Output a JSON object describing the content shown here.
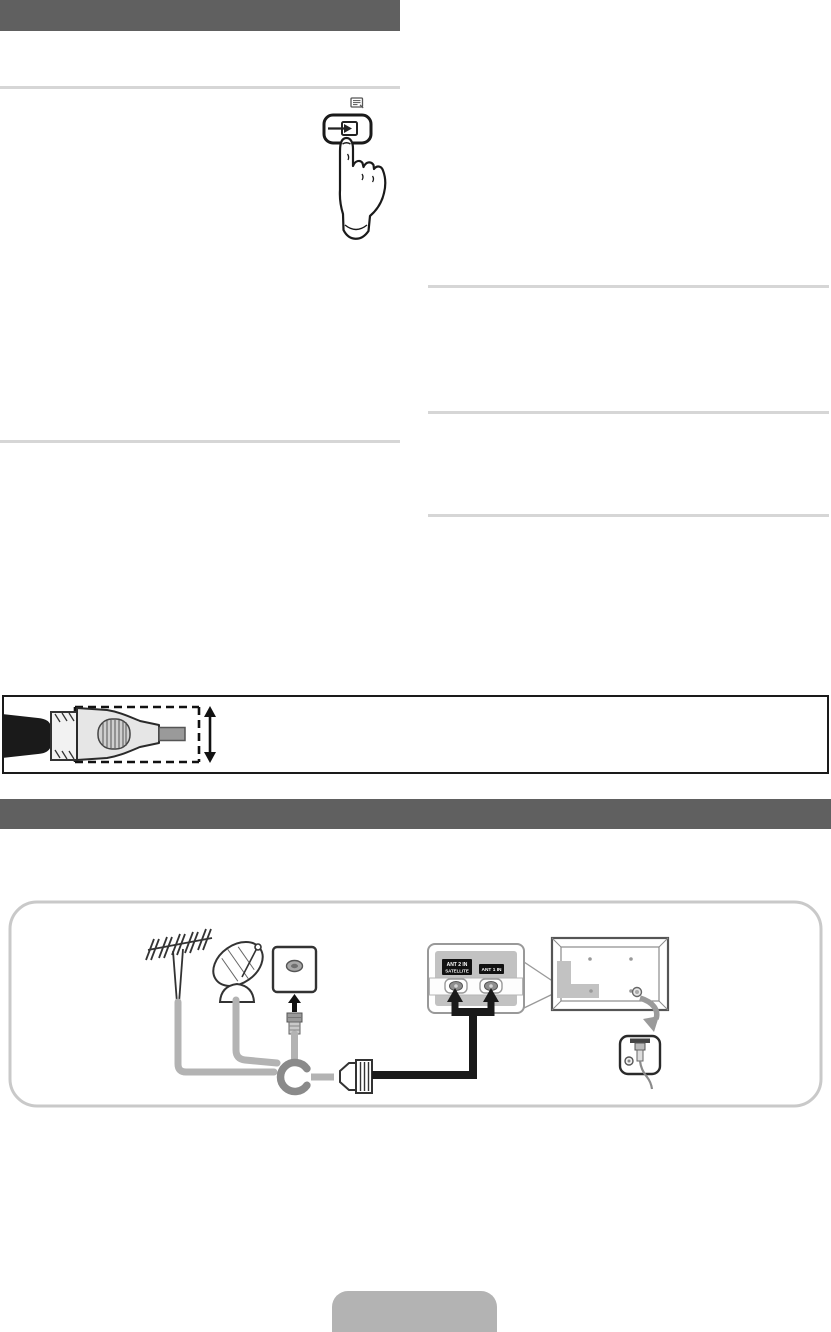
{
  "document": {
    "kind": "tv-user-manual-page"
  },
  "colors": {
    "section_header_bar": "#606060",
    "divider_rule": "#d6d6d6",
    "figure_box_border": "#1a1a1a",
    "diagram_frame_border": "#c9c9c9",
    "cable_gray": "#b3b3b3",
    "junction_gray": "#8a8a8a",
    "ports_panel_fill": "#c2c2c2",
    "black_cable": "#1a1a1a",
    "footer_tab_fill": "#b3b3b3",
    "curved_arrow_gray": "#9a9a9a"
  },
  "antenna_diagram": {
    "ant2_label_line1": "ANT 2 IN",
    "ant2_label_line2": "SATELLITE",
    "ant1_label": "ANT 1 IN"
  },
  "icons": [
    "note-icon",
    "source-button-icon",
    "pressing-hand-icon",
    "aerial-antenna-icon",
    "satellite-dish-icon",
    "wall-socket-icon",
    "coax-plug-icon",
    "cable-junction-icon",
    "coax-connector-icon",
    "antenna-ports-panel",
    "tv-back-panel",
    "port-detail-inset",
    "curved-arrow-icon",
    "dimension-arrow-icon",
    "cable-connector-figure"
  ]
}
